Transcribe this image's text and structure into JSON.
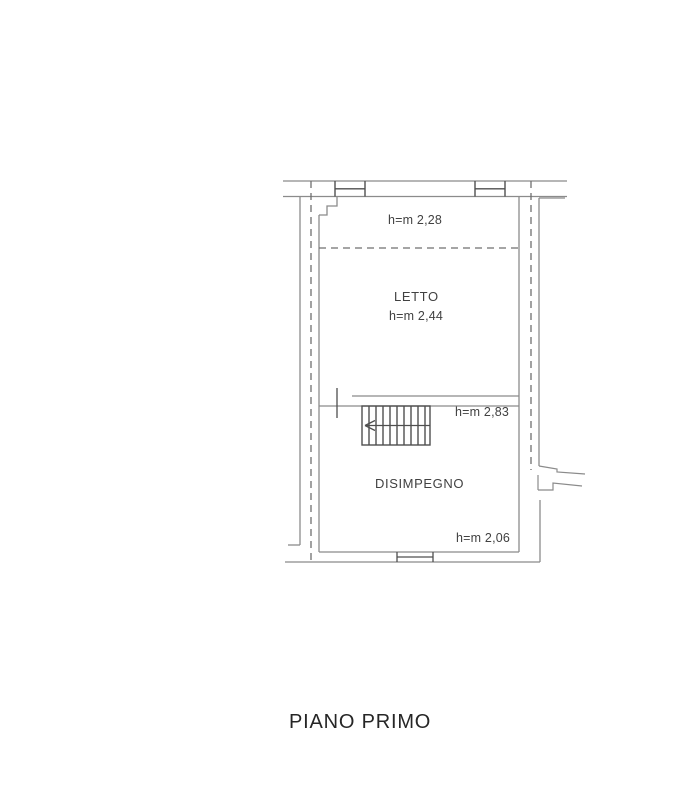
{
  "title": "PIANO PRIMO",
  "rooms": {
    "letto": {
      "name": "LETTO",
      "height": "h=m 2,44",
      "upper_height": "h=m 2,28"
    },
    "disimpegno": {
      "name": "DISIMPEGNO",
      "height": "h=m 2,06"
    },
    "stairs": {
      "height": "h=m 2,83"
    }
  },
  "colors": {
    "wall_line": "#8b8b8b",
    "dark_line": "#4f4f4f",
    "dashed_line": "#6f6f6f",
    "label_text": "#414141",
    "title_text": "#262626",
    "background": "#ffffff"
  }
}
